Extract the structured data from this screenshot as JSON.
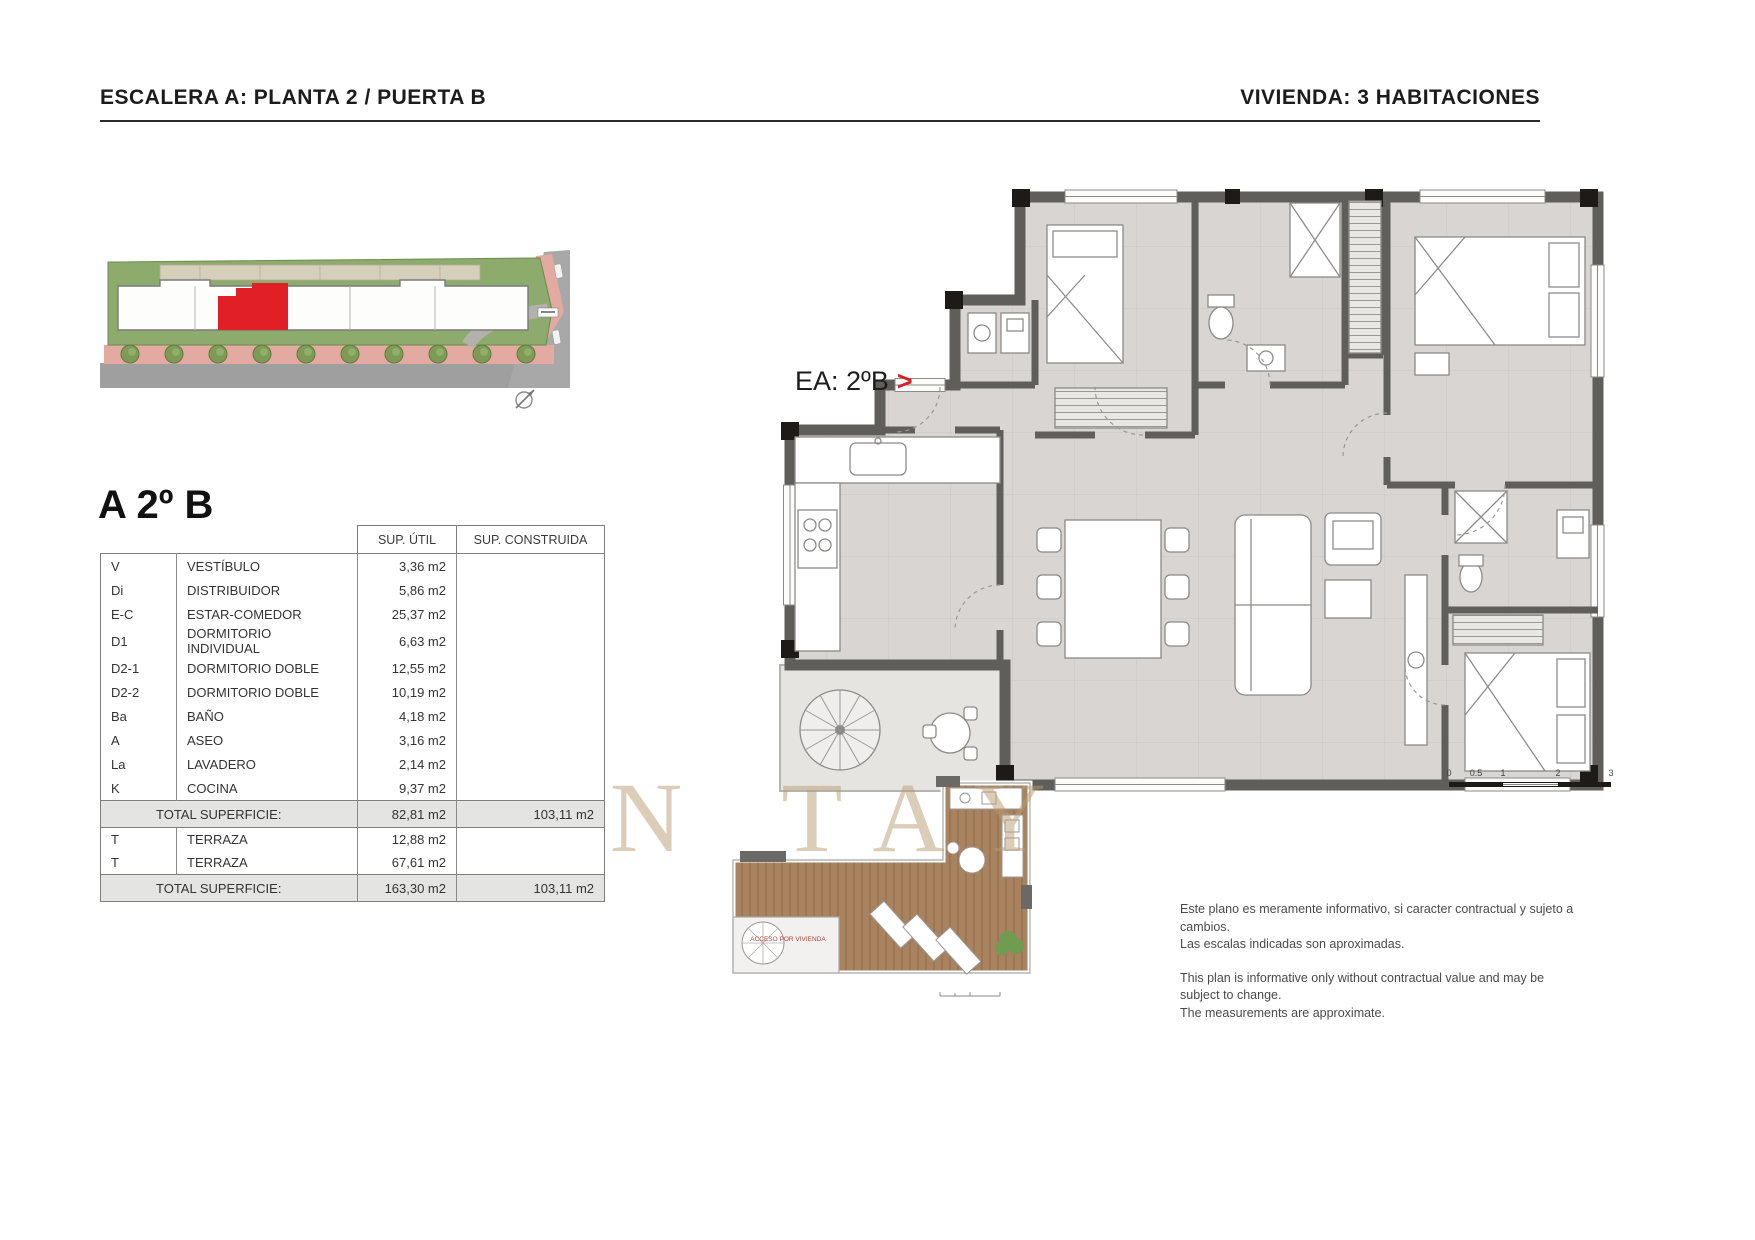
{
  "page": {
    "header_left": "ESCALERA A: PLANTA 2 / PUERTA B",
    "header_right": "VIVIENDA: 3 HABITACIONES"
  },
  "unit": {
    "title": "A 2º B",
    "plan_label": "EA: 2ºB",
    "plan_label_arrow": ">"
  },
  "areas_table": {
    "headers": [
      "SUP. ÚTIL",
      "SUP. CONSTRUIDA"
    ],
    "rows": [
      {
        "code": "V",
        "name": "VESTÍBULO",
        "util": "3,36 m2",
        "built": ""
      },
      {
        "code": "Di",
        "name": "DISTRIBUIDOR",
        "util": "5,86 m2",
        "built": ""
      },
      {
        "code": "E-C",
        "name": "ESTAR-COMEDOR",
        "util": "25,37 m2",
        "built": ""
      },
      {
        "code": "D1",
        "name": "DORMITORIO INDIVIDUAL",
        "util": "6,63 m2",
        "built": ""
      },
      {
        "code": "D2-1",
        "name": "DORMITORIO DOBLE",
        "util": "12,55 m2",
        "built": ""
      },
      {
        "code": "D2-2",
        "name": "DORMITORIO DOBLE",
        "util": "10,19 m2",
        "built": ""
      },
      {
        "code": "Ba",
        "name": "BAÑO",
        "util": "4,18 m2",
        "built": ""
      },
      {
        "code": "A",
        "name": "ASEO",
        "util": "3,16 m2",
        "built": ""
      },
      {
        "code": "La",
        "name": "LAVADERO",
        "util": "2,14 m2",
        "built": ""
      },
      {
        "code": "K",
        "name": "COCINA",
        "util": "9,37 m2",
        "built": ""
      }
    ],
    "total_row_1": {
      "label": "TOTAL SUPERFICIE:",
      "util": "82,81 m2",
      "built": "103,11 m2"
    },
    "terrace_rows": [
      {
        "code": "T",
        "name": "TERRAZA",
        "util": "12,88 m2",
        "built": ""
      },
      {
        "code": "T",
        "name": "TERRAZA",
        "util": "67,61 m2",
        "built": ""
      }
    ],
    "total_row_2": {
      "label": "TOTAL SUPERFICIE:",
      "util": "163,30 m2",
      "built": "103,11 m2"
    }
  },
  "terrace_plan": {
    "access_label": "ACCESO POR VIVIENDA"
  },
  "scale_bar": {
    "ticks": [
      "0",
      "0.5",
      "1",
      "2",
      "3"
    ]
  },
  "watermark": "N TAY",
  "disclaimer": {
    "es_line1": "Este plano es meramente informativo, si caracter contractual y sujeto a cambios.",
    "es_line2": "Las escalas indicadas son aproximadas.",
    "en_line1": "This plan is informative only without contractual value and may be subject to change.",
    "en_line2": "The measurements are approximate."
  },
  "colors": {
    "highlight_red": "#e01f26",
    "accent_red": "#d22128",
    "wall_gray": "#5f5e5b",
    "floor_gray": "#d8d5d2",
    "wood": "#a9825f",
    "grass_green": "#8cab6c"
  }
}
